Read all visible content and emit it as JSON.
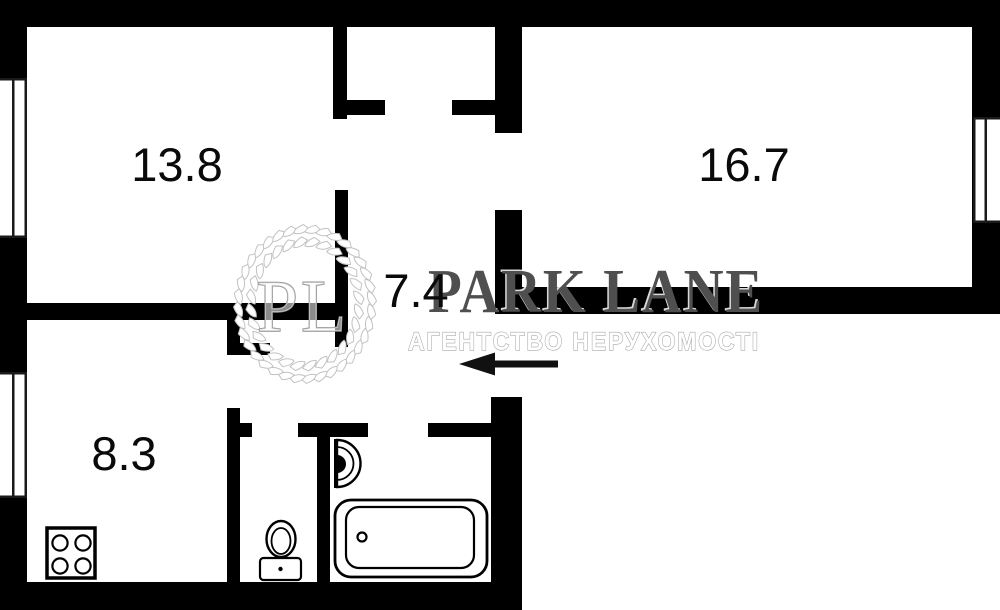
{
  "floor_plan": {
    "room_labels": [
      {
        "id": "room-top-left",
        "area": "13.8"
      },
      {
        "id": "room-right",
        "area": "16.7"
      },
      {
        "id": "hallway",
        "area": "7.4"
      },
      {
        "id": "kitchen",
        "area": "8.3"
      }
    ],
    "fixtures": [
      "stove",
      "toilet",
      "sink",
      "bathtub"
    ],
    "entrance_arrow": {
      "direction": "left"
    }
  },
  "watermark": {
    "initials": "PL",
    "brand": "PARK LANE",
    "tagline": "АГЕНТСТВО НЕРУХОМОСТІ"
  },
  "colors": {
    "wall": "#000000",
    "background": "#ffffff",
    "label_text": "#0a0a0a",
    "brand_text": "#4f4f4f",
    "brand_highlight": "#ffffff",
    "tagline_fill": "#ffffff",
    "tagline_outline": "#a8a8a8",
    "watermark_line": "#c2c2c2",
    "arrow": "#111111"
  }
}
